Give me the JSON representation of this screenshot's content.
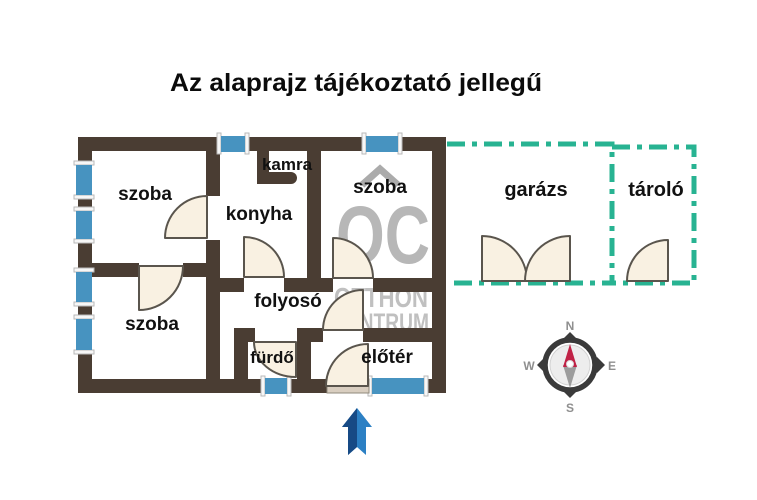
{
  "title": "Az alaprajz tájékoztató jellegű",
  "rooms": {
    "szoba_top_left": "szoba",
    "szoba_bottom_left": "szoba",
    "szoba_top_right": "szoba",
    "konyha": "konyha",
    "kamra": "kamra",
    "folyoso": "folyosó",
    "furdo": "fürdő",
    "eloter": "előtér"
  },
  "outbuildings": {
    "garazs": "garázs",
    "tarolo": "tároló"
  },
  "watermark": {
    "initials": "OC",
    "line1": "OTTHON",
    "line2": "CENTRUM"
  },
  "compass": {
    "north": "N",
    "south": "S",
    "west": "W",
    "east": "E"
  },
  "colors": {
    "wall": "#4a3d33",
    "window": "#4793c0",
    "door_fill": "#f9f1e2",
    "outbuilding_dash": "#28b392",
    "watermark_gray": "#b7b7b7",
    "arrow_dark": "#174a85",
    "arrow_light": "#2c80c4",
    "needle_north": "#c02246",
    "needle_south": "#9c9c9c"
  }
}
